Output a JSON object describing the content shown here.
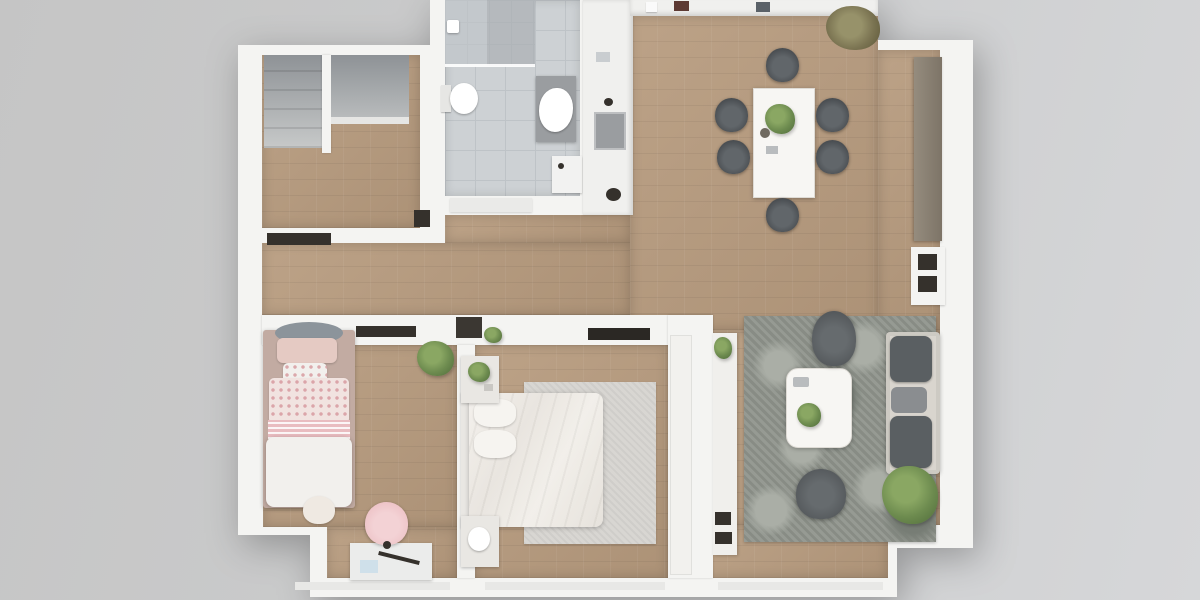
{
  "scene": {
    "title": "Apartment floor plan – top-down 3D render",
    "type": "3d-floor-plan-top-view",
    "visible_text": "none"
  },
  "colors": {
    "background_left": "#c5c5c5",
    "background_mid": "#cccdce",
    "background_right": "#d6d7d9",
    "wall": "#f4f4f2",
    "sill": "#e8e8e6",
    "wood": "#b79b7e",
    "tile": "#cdd1d4",
    "tile_line": "#bec3c7",
    "shower": "#c3c8cc",
    "counter": "#f0f0ee",
    "closet_gray": "#9ea2a5",
    "chair_dark": "#45494d",
    "table_white": "#f7f6f3",
    "sideboard": "#8a8174",
    "cabinet_dark": "#35312c",
    "rug": "#8f948c",
    "rug_light": "#aaaea6",
    "sofa": "#d9d5ce",
    "sofa_cushion": "#5a5f62",
    "armchair": "#53575a",
    "bed": "#eeebe6",
    "pillow": "#f6f4f0",
    "bedroom_rug": "#d6d4d0",
    "nightstand": "#e9e7e3",
    "kids_frame": "#c2aba2",
    "kids_pink": "#e5cac3",
    "kids_dot": "#f1e3e0",
    "kids_stripe": "#e9bcc0",
    "kids_white": "#f2f0ed",
    "canopy": "#8c949b",
    "chair_pink": "#edc2c6",
    "desk": "#ebeceb",
    "plant": "#6d8b4f",
    "plant_dark": "#4f6b3a",
    "plant_olive": "#7b7452",
    "porcelain": "#ffffff",
    "vanity": "#9a9da0",
    "machine": "#f2f2f1",
    "tv_dark": "#2b2824",
    "paper_blue": "#cfe0ea",
    "doorway_dark": "#3b3732"
  },
  "rooms": [
    {
      "id": "entry-hall",
      "label": "Entry hall",
      "floor": "wood",
      "furniture": [
        "staircase-closet",
        "wardrobe-niche",
        "niche-shelf"
      ]
    },
    {
      "id": "bathroom",
      "label": "Bathroom",
      "floor": "tile",
      "furniture": [
        "shower",
        "shower-head",
        "toilet",
        "vanity-sink",
        "washing-machine",
        "door"
      ]
    },
    {
      "id": "kitchen",
      "label": "Kitchen",
      "floor": "counter-white",
      "furniture": [
        "counter-left",
        "counter-top-wall",
        "sink",
        "faucet",
        "pot",
        "small-appliances"
      ]
    },
    {
      "id": "living-dining-room",
      "label": "Living / dining room",
      "floor": "wood",
      "furniture": [
        "dining-table",
        {
          "item": "dining-chair",
          "count": 6
        },
        "table-plant",
        "corner-plant",
        "sideboard",
        "media-cabinet",
        "area-rug",
        "coffee-table",
        {
          "item": "armchair",
          "count": 2
        },
        "sofa",
        "floor-plant",
        "wall-shelf"
      ]
    },
    {
      "id": "master-bedroom",
      "label": "Master bedroom",
      "floor": "wood",
      "furniture": [
        "double-bed",
        {
          "item": "pillow",
          "count": 2
        },
        {
          "item": "nightstand",
          "count": 2
        },
        "rug",
        "wall-tv",
        "wardrobe"
      ]
    },
    {
      "id": "kids-bedroom",
      "label": "Kids bedroom",
      "floor": "wood",
      "furniture": [
        "single-bed",
        "canopy",
        "pink-pillows",
        "polka-dot-duvet",
        "wall-shelf",
        "plant",
        "desk",
        "desk-chair",
        "teddy-bear"
      ]
    },
    {
      "id": "hallway",
      "label": "Hallway",
      "floor": "wood",
      "furniture": [
        "low-cabinet",
        "wall-plant",
        {
          "item": "doorway",
          "count": 2
        }
      ]
    }
  ]
}
